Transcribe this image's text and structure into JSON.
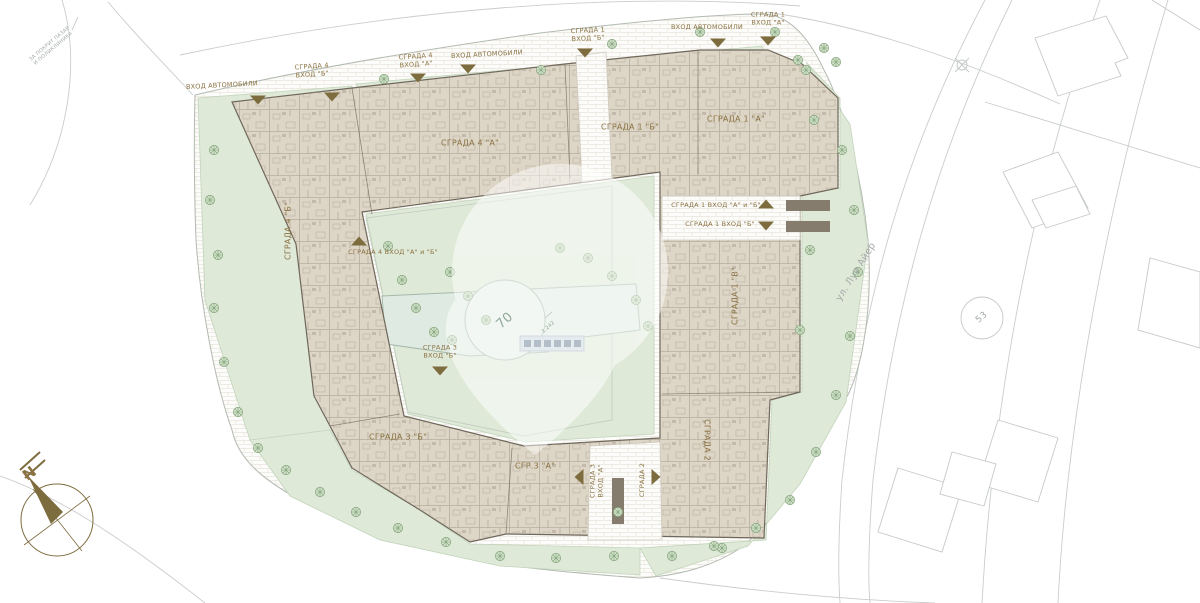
{
  "title": "Ситуационен план - жилищен комплекс",
  "palette": {
    "brown": "#8a7243",
    "arrow": "#7d6c3e",
    "gray": "#a4a9a9",
    "graygreen": "#8fa89b",
    "building_fill": "#ddd5c5",
    "building_wall": "#6e665a",
    "green": "#dfe9d8",
    "water": "#dfebe2"
  },
  "labels": [
    {
      "name": "context-note",
      "text": "ЗА ПОКРИТ ПАЗАР\nИ ПОЛИКЛИНИКА",
      "x": 52,
      "y": 47,
      "rot": -40,
      "size": 5,
      "c": "gray"
    },
    {
      "name": "entrance-cars-1",
      "text": "ВХОД АВТОМОБИЛИ",
      "x": 222,
      "y": 86,
      "rot": -3,
      "size": 6.5,
      "c": "brown"
    },
    {
      "name": "bldg4-entB-label",
      "text": "СГРАДА 4\nВХОД \"Б\"",
      "x": 312,
      "y": 71,
      "rot": -4,
      "size": 6.5,
      "c": "brown"
    },
    {
      "name": "bldg4-entA-label",
      "text": "СГРАДА 4\nВХОД \"А\"",
      "x": 416,
      "y": 61,
      "rot": -4,
      "size": 6.5,
      "c": "brown"
    },
    {
      "name": "entrance-cars-2",
      "text": "ВХОД АВТОМОБИЛИ",
      "x": 487,
      "y": 55,
      "rot": -3,
      "size": 6.5,
      "c": "brown"
    },
    {
      "name": "bldg1-entB-label",
      "text": "СГРАДА 1\nВХОД \"Б\"",
      "x": 588,
      "y": 35,
      "rot": -3,
      "size": 6.5,
      "c": "brown"
    },
    {
      "name": "entrance-cars-3",
      "text": "ВХОД АВТОМОБИЛИ",
      "x": 707,
      "y": 28,
      "rot": 0,
      "size": 6.5,
      "c": "brown"
    },
    {
      "name": "bldg1-entA-label",
      "text": "СГРАДА 1\nВХОД \"А\"",
      "x": 768,
      "y": 19,
      "rot": 0,
      "size": 6.5,
      "c": "brown"
    },
    {
      "name": "bldg4A-label",
      "text": "СГРАДА 4 \"А\"",
      "x": 470,
      "y": 143,
      "rot": 0,
      "size": 8,
      "c": "brown"
    },
    {
      "name": "bldg1B-label",
      "text": "СГРАДА 1 \"Б\"",
      "x": 630,
      "y": 127,
      "rot": 0,
      "size": 8,
      "c": "brown"
    },
    {
      "name": "bldg1A-label",
      "text": "СГРАДА 1 \"А\"",
      "x": 736,
      "y": 119,
      "rot": 0,
      "size": 8,
      "c": "brown"
    },
    {
      "name": "bldg4B-label",
      "text": "СГРАДА 4 \"Б\"",
      "x": 288,
      "y": 231,
      "rot": -90,
      "size": 8,
      "c": "brown"
    },
    {
      "name": "bldg4-entAB-label",
      "text": "СГРАДА 4  ВХОД \"А\" и \"Б\"",
      "x": 393,
      "y": 253,
      "rot": 0,
      "size": 6.5,
      "c": "brown"
    },
    {
      "name": "bldg1-entAB-label",
      "text": "СГРАДА 1 ВХОД \"А\" и \"Б\"",
      "x": 716,
      "y": 206,
      "rot": 0,
      "size": 6.5,
      "c": "brown"
    },
    {
      "name": "bldg1-entB2-label",
      "text": "СГРАДА 1 ВХОД \"Б\"",
      "x": 720,
      "y": 225,
      "rot": 0,
      "size": 6.5,
      "c": "brown"
    },
    {
      "name": "bldg1V-label",
      "text": "СГРАДА 1 \"В\"",
      "x": 735,
      "y": 296,
      "rot": -90,
      "size": 8,
      "c": "brown"
    },
    {
      "name": "bldg3-entB-label",
      "text": "СГРАДА 3\nВХОД \"Б\"",
      "x": 440,
      "y": 352,
      "rot": 0,
      "size": 6.5,
      "c": "brown"
    },
    {
      "name": "bldg3B-label",
      "text": "СГРАДА 3 \"Б\"",
      "x": 398,
      "y": 437,
      "rot": 0,
      "size": 8,
      "c": "brown"
    },
    {
      "name": "bldg3A-label",
      "text": "СГР.3 \"А\"",
      "x": 535,
      "y": 466,
      "rot": 0,
      "size": 8,
      "c": "brown"
    },
    {
      "name": "bldg3-entA-label",
      "text": "СГРАДА 3\nВХОД \"А\"",
      "x": 597,
      "y": 481,
      "rot": -90,
      "size": 6.5,
      "c": "brown"
    },
    {
      "name": "bldg2-ent-label",
      "text": "СГРАДА 2",
      "x": 643,
      "y": 480,
      "rot": -90,
      "size": 6.5,
      "c": "brown"
    },
    {
      "name": "bldg2-label",
      "text": "СГРАДА 2",
      "x": 707,
      "y": 440,
      "rot": 90,
      "size": 8,
      "c": "brown"
    },
    {
      "name": "street-name",
      "text": "ул. Луи Айер",
      "x": 856,
      "y": 272,
      "rot": -58,
      "size": 9.5,
      "c": "gray"
    },
    {
      "name": "site-number",
      "text": "53",
      "x": 982,
      "y": 318,
      "rot": -40,
      "size": 9,
      "c": "gray"
    },
    {
      "name": "courtyard-number",
      "text": "70",
      "x": 505,
      "y": 321,
      "rot": -42,
      "size": 13,
      "c": "graygreen"
    },
    {
      "name": "spot-elevation",
      "text": "1.242",
      "x": 549,
      "y": 328,
      "rot": -42,
      "size": 5,
      "c": "graygreen"
    },
    {
      "name": "compass-north-letter",
      "text": "N",
      "x": 30,
      "y": 474,
      "rot": -38,
      "size": 15,
      "c": "brown",
      "bold": true
    }
  ],
  "entrance_arrows": [
    {
      "name": "arrow-cars-1",
      "x": 258,
      "y": 100,
      "dir": "down"
    },
    {
      "name": "arrow-bldg4-entB",
      "x": 332,
      "y": 97,
      "dir": "down"
    },
    {
      "name": "arrow-bldg4-entA",
      "x": 418,
      "y": 78,
      "dir": "down"
    },
    {
      "name": "arrow-cars-2",
      "x": 468,
      "y": 69,
      "dir": "down"
    },
    {
      "name": "arrow-bldg1-entB",
      "x": 585,
      "y": 53,
      "dir": "down"
    },
    {
      "name": "arrow-cars-3",
      "x": 718,
      "y": 43,
      "dir": "down"
    },
    {
      "name": "arrow-bldg1-entA",
      "x": 768,
      "y": 41,
      "dir": "down"
    },
    {
      "name": "arrow-bldg4-entAB",
      "x": 359,
      "y": 241,
      "dir": "up"
    },
    {
      "name": "arrow-bldg1-entAB",
      "x": 766,
      "y": 204,
      "dir": "up"
    },
    {
      "name": "arrow-bldg1-entB2",
      "x": 766,
      "y": 226,
      "dir": "down"
    },
    {
      "name": "arrow-bldg3-entB",
      "x": 440,
      "y": 371,
      "dir": "down"
    },
    {
      "name": "arrow-bldg3-entA",
      "x": 579,
      "y": 477,
      "dir": "left"
    },
    {
      "name": "arrow-bldg2-ent",
      "x": 656,
      "y": 477,
      "dir": "right"
    }
  ]
}
